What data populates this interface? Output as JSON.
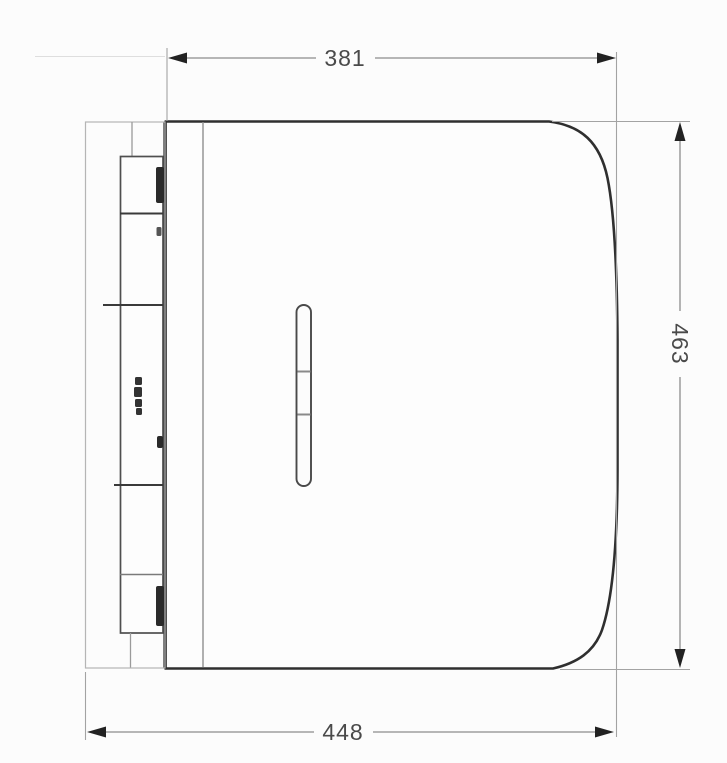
{
  "page": {
    "background": "#fcfcfc"
  },
  "drawing": {
    "units": "mm",
    "dimensions": {
      "width_top": "381",
      "height_right": "463",
      "depth_bottom": "448"
    },
    "marks": {
      "brand": "brand-mark-icon",
      "arrow": "dimension-arrowhead-icon"
    },
    "colors": {
      "outline": "#2f2f2f",
      "panel_line": "#4f4f4f",
      "thin_line": "#b5b5b5",
      "seam_line": "#8f8f8f",
      "slot_line": "#4a4a4a",
      "dimension_line": "#8c8c8c",
      "extension_line": "#a3a3a3",
      "arrow_fill": "#222222",
      "text": "#4a4a4a",
      "clip_fill": "#2a2a2a"
    }
  }
}
